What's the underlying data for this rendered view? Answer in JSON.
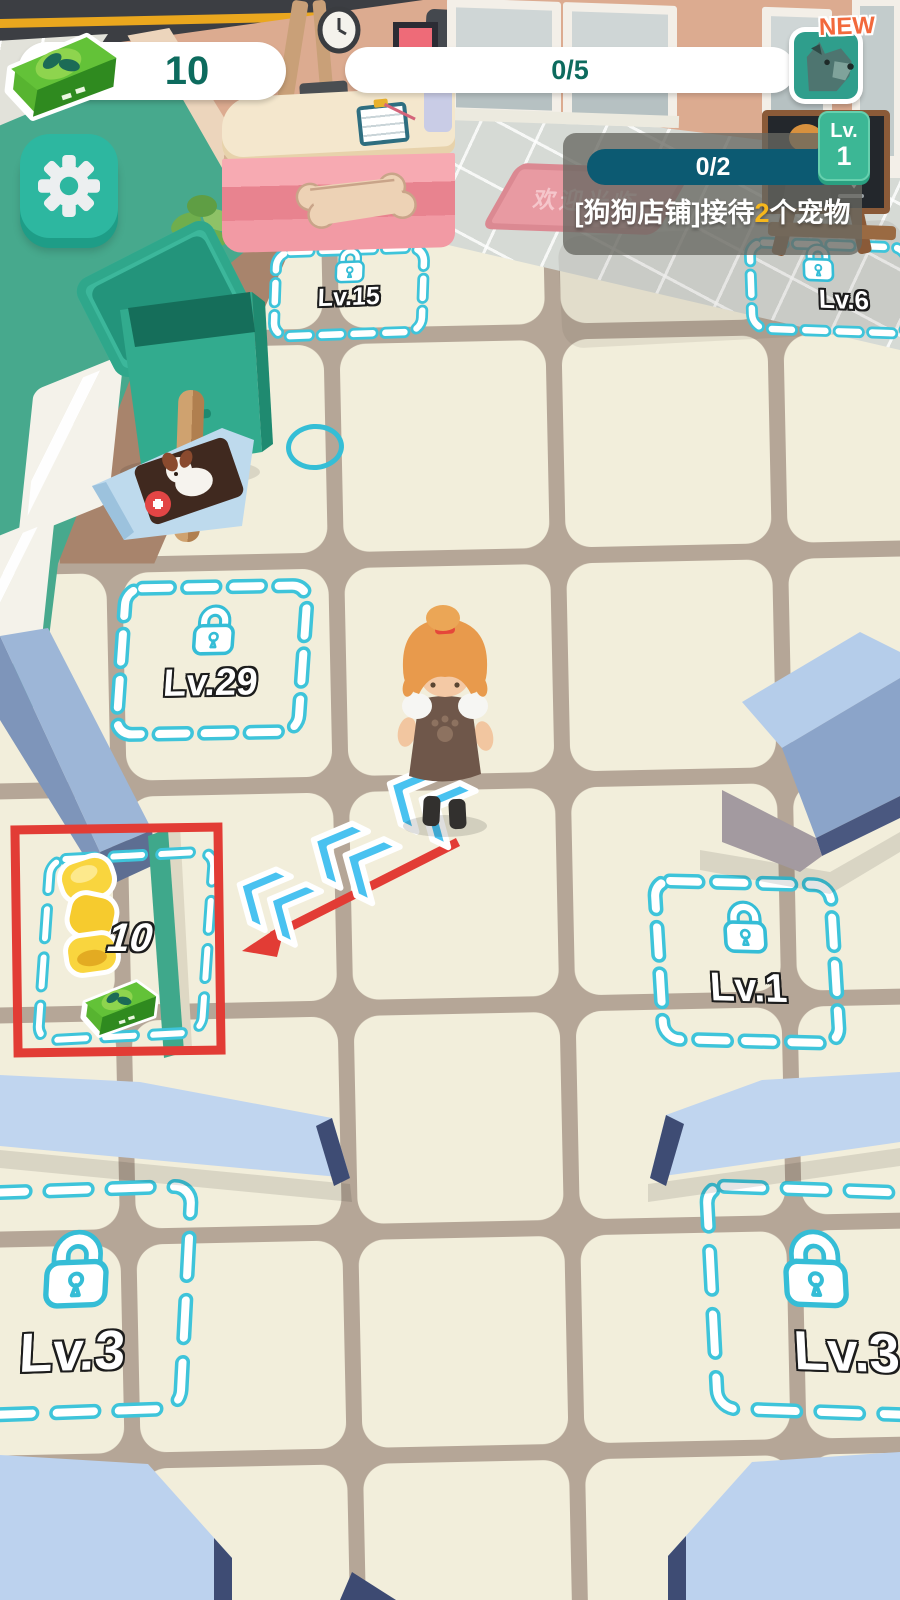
{
  "hud": {
    "money": {
      "value": "10"
    },
    "wave_progress": {
      "value": "0/5"
    },
    "new_pet_badge": {
      "label": "NEW"
    },
    "quest": {
      "progress": "0/2",
      "task_prefix": "[狗狗店铺]接待",
      "task_count": "2",
      "task_suffix": "个宠物",
      "level_label": "Lv.",
      "level_value": "1"
    }
  },
  "zones": {
    "lv15": {
      "label": "Lv.15"
    },
    "lv6": {
      "label": "Lv.6"
    },
    "lv29": {
      "label": "Lv.29"
    },
    "lv1": {
      "label": "Lv.1"
    },
    "lv3_left": {
      "label": "Lv.3"
    },
    "lv3_right": {
      "label": "Lv.3"
    }
  },
  "tutorial": {
    "unlock_cost": "10"
  },
  "scene": {
    "doormat_text": "欢迎光临"
  },
  "colors": {
    "teal_accent": "#2db7a0",
    "zone_dash": "#3ec4da",
    "highlight_red": "#e23c35",
    "money_green": "#57b430",
    "quest_bar": "#0c5a72",
    "level_badge": "#3cb795",
    "new_orange": "#f2693c",
    "floor_tile": "#f2eedb",
    "wall_green": "#47a98d"
  }
}
